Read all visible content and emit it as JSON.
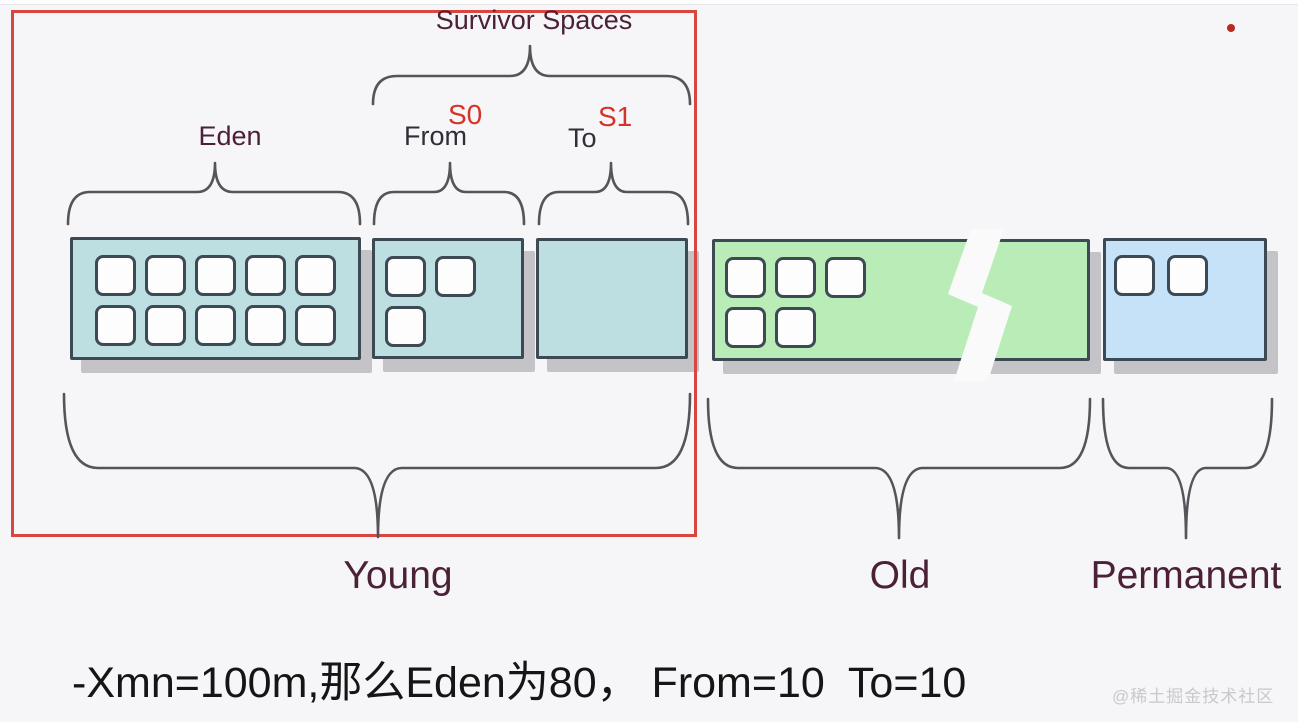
{
  "colors": {
    "background": "#f6f5f7",
    "box_border": "#3e4a53",
    "survivor_fill": "#bedfe2",
    "old_fill": "#b9ecb6",
    "permanent_fill": "#c6e2f8",
    "cell_fill": "#fdfdfe",
    "shadow": "#c4c3c7",
    "brace": "#54545a",
    "outline_red": "#d9453f",
    "break_fill": "#fafafb",
    "label_maroon": "#4b2138",
    "label_dark": "#2f2f37",
    "label_red": "#d53228",
    "caption_text": "#151515",
    "watermark_gray": "#c9c8cd"
  },
  "header": {
    "survivor_spaces_label": "Survivor Spaces"
  },
  "regions": {
    "eden": {
      "label": "Eden",
      "cell_rows": [
        5,
        5
      ]
    },
    "s0": {
      "label": "From",
      "superscript": "S0",
      "cell_rows": [
        2,
        1
      ]
    },
    "s1": {
      "label": "To",
      "superscript": "S1",
      "cell_rows": []
    },
    "old": {
      "cell_rows": [
        3,
        2
      ]
    },
    "permanent": {
      "cell_rows": [
        2
      ]
    }
  },
  "generations": {
    "young_label": "Young",
    "old_label": "Old",
    "permanent_label": "Permanent"
  },
  "caption": "-Xmn=100m,那么Eden为80， From=10  To=10",
  "watermark": "@稀土掘金技术社区"
}
